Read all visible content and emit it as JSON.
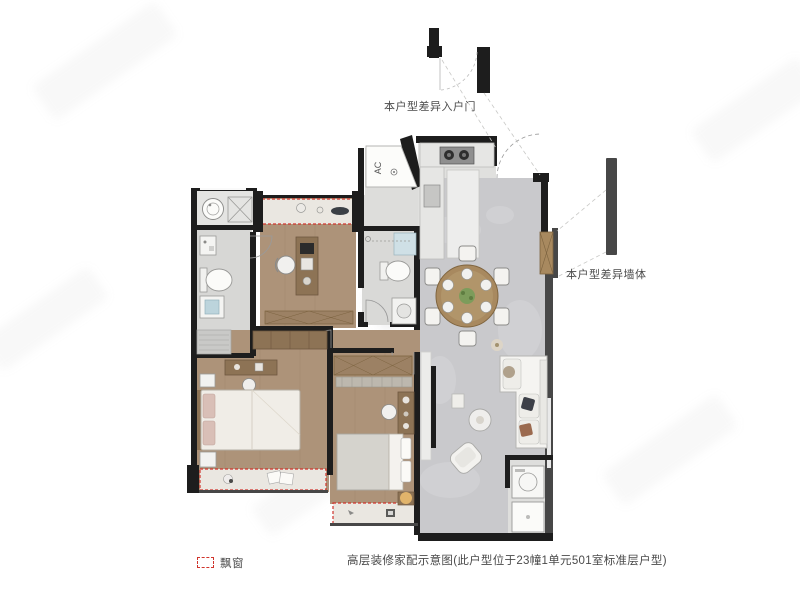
{
  "annotations": {
    "entry_diff_label": "本户型差异入户门",
    "wall_diff_label": "本户型差异墙体"
  },
  "plan": {
    "ac_label": "AC"
  },
  "legend": {
    "bay_window_label": "飘窗",
    "bay_window_swatch_color": "#d0342c"
  },
  "caption": {
    "text": "高层装修家配示意图(此户型位于23幢1单元501室标准层户型)"
  },
  "colors": {
    "wall": "#1d1d1d",
    "wall-gray": "#474747",
    "wood": "#ad9379",
    "wood-dark": "#8d7355",
    "tile": "#c9c9cc",
    "tile-light": "#e0e0de",
    "bath-floor": "#d7d7d5",
    "bay-red": "#d0342c",
    "cabinet": "#a8895f",
    "label-text": "#4a4a4a"
  }
}
